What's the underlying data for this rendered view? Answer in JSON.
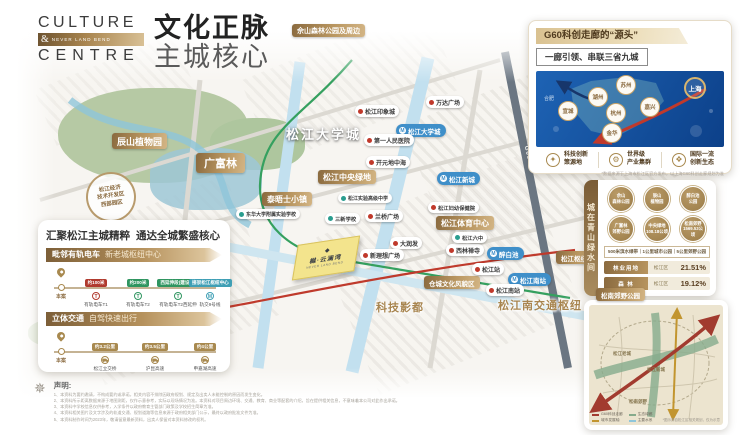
{
  "theme": {
    "gold": "#a8894f",
    "deep_gold": "#7d5f38",
    "red": "#c0392b",
    "green": "#2f9560",
    "metro_blue": "#3f8fc9",
    "map_blue": "#0c4089"
  },
  "brand": {
    "line1": "CULTURE",
    "amp": "&",
    "tagline": "NEVER LAND BEND",
    "line2": "CENTRE"
  },
  "headline": {
    "title": "文化正脉",
    "subtitle": "主城核心"
  },
  "map": {
    "labels": {
      "sheshan": "佘山森林公园及周边",
      "chenshan": "辰山植物园",
      "gfl": "广富林",
      "univ_big": "松江大学城",
      "central_green": "松江中央绿地",
      "thames": "泰晤士小镇",
      "sports": "松江体育中心",
      "cangcheng": "仓城文化风貌区",
      "yongfeng": "永丰城市公园",
      "hub": "松江枢纽",
      "songnan": "松南郊野公园",
      "south_hub": "松江南交通枢纽",
      "film": "科技影都",
      "edz_l1": "松江经济",
      "edz_l2": "技术开发区",
      "edz_l3": "西部园区",
      "g60_road": "G60"
    },
    "metro": {
      "univ": "松江大学城",
      "xincheng": "松江新城",
      "zuibaichi": "醉白池",
      "nanstation": "松江南站"
    },
    "poi": {
      "impression": "松江印象城",
      "wanda": "万达广场",
      "hospital": "第一人民医院",
      "kaiyuan": "开元地中海",
      "sanxin": "三新学校",
      "lanqiao": "兰桥广场",
      "rtmart": "大润发",
      "xinlixiang": "新理想广场",
      "xilin": "西林禅寺",
      "sjstation": "松江站",
      "sjsouth": "松江南站",
      "liuzhong": "松江六中",
      "fuyou": "松江妇幼保健院",
      "donghua": "东华大学附属实验学校",
      "gaoji": "松江实验高级中学"
    },
    "project": {
      "name": "樾·云澜湾",
      "sub": "NEVER LAND BEND"
    }
  },
  "transit": {
    "title_left": "汇聚松江主城精粹",
    "title_right": "通达全城繁盛核心",
    "s1": {
      "label": "毗邻有轨电车",
      "sub": "新老城枢纽中心",
      "origin": "本案",
      "stops": [
        {
          "badge": "约100米",
          "name": "有轨电车T1"
        },
        {
          "badge": "约200米",
          "name": "有轨电车T2"
        },
        {
          "badge": "西延伸段(建设中)",
          "name": "有轨电车T2西延伸"
        },
        {
          "badge": "接驳松江枢纽中心",
          "name": "轨交9号线"
        }
      ]
    },
    "s2": {
      "label": "立体交通",
      "sub": "自驾快速出行",
      "origin": "本案",
      "stops": [
        {
          "badge": "约3.2公里",
          "name": "松江立交桥"
        },
        {
          "badge": "约3.5公里",
          "name": "沪昆高速"
        },
        {
          "badge": "约4公里",
          "name": "申嘉湖高速"
        }
      ]
    }
  },
  "g60": {
    "title": "G60科创走廊的“源头”",
    "subtitle": "一廊引领、串联三省九城",
    "shanghai": "上海",
    "hefei": "合肥",
    "cities": [
      {
        "name": "苏州"
      },
      {
        "name": "湖州"
      },
      {
        "name": "宣城"
      },
      {
        "name": "杭州"
      },
      {
        "name": "嘉兴"
      },
      {
        "name": "金华"
      }
    ],
    "features": [
      {
        "l1": "科技创新",
        "l2": "策源地"
      },
      {
        "l1": "世界级",
        "l2": "产业集群"
      },
      {
        "l1": "国际一流",
        "l2": "创新生态"
      }
    ],
    "caption": "*数据来源于上海市松江区官方发布，以上海G60科创走廊规划为准"
  },
  "green": {
    "vtitle": "城在青山绿水间",
    "circles": [
      {
        "l1": "佘山",
        "l2": "森林公园"
      },
      {
        "l1": "辰山",
        "l2": "植物园"
      },
      {
        "l1": "醉白池",
        "l2": "公园"
      },
      {
        "l1": "广富林",
        "l2": "郊野公园"
      },
      {
        "l1": "中央绿地",
        "l2": "108.18公顷"
      },
      {
        "l1": "松南郊野",
        "l2": "1569.53公顷"
      }
    ],
    "strip": "500米滨水绿带｜1公里城市公园｜5公里郊野公园",
    "rows": [
      {
        "label": "林业用地",
        "mid": "松江区",
        "value": "21.51%"
      },
      {
        "label": "森  林",
        "mid": "松江区",
        "value": "19.12%"
      }
    ]
  },
  "minimap": {
    "labels": [
      "松江老城",
      "松江新城",
      "松南郊野"
    ],
    "legend": [
      "G60科创走廊",
      "生态绿廊",
      "城市发展轴",
      "主要水系"
    ],
    "caption": "*图示源自松江区相关规划，仅为示意"
  },
  "disclaimer": {
    "heading": "声明:",
    "lines": [
      "1、本资料为要约邀请，不构成要约或承诺，相关内容不排除因政府规划、规定及出卖人未能控制的原因而发生变化。",
      "2、本资料所示距离数据来源于地图测距，仅作示意参考，实际以现场情况为准。本资料对项目周边环境、交通、教育、商业等配套的介绍，旨在提供相关信息，不意味着本公司对此作出承诺。",
      "3、本资料中学校信息仅供参考，入学条件以政府教育主管部门政策及学校招生简章为准。",
      "4、本资料相关图片及文字涉及的轨道交通、规划道路等信息来源于政府相关部门公示，最终以政府批准文件为准。",
      "5、本资料制作时间为2023年，敬请留意最新资料，出卖人保留对本资料修改的权利。"
    ]
  }
}
